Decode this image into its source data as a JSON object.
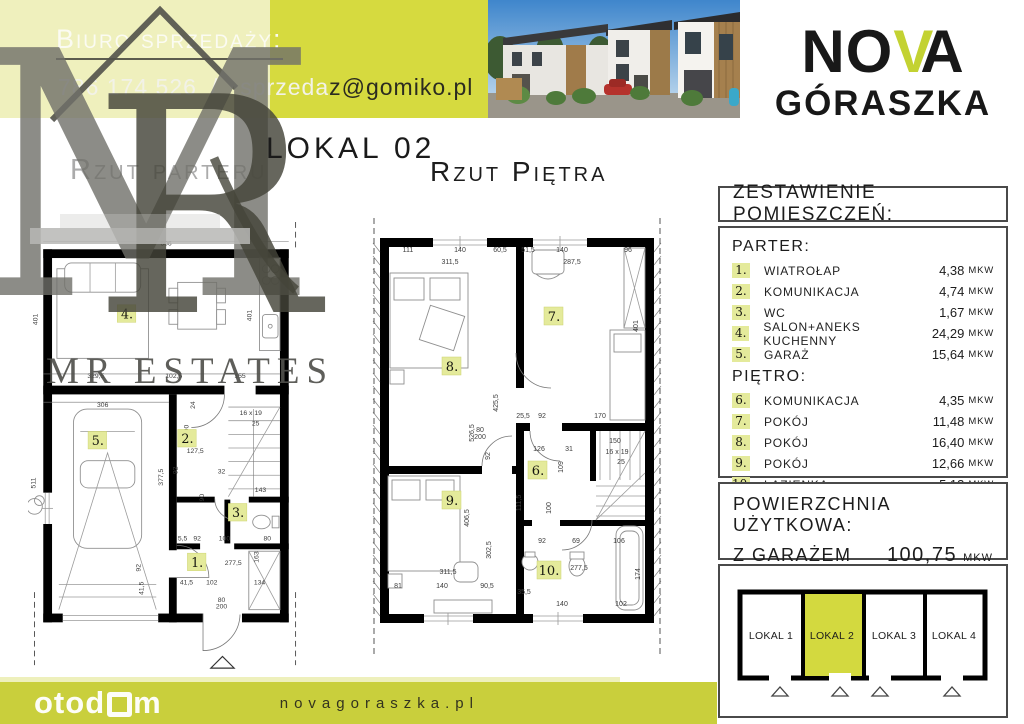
{
  "contact": {
    "title": "Biuro sprzedaży:",
    "phone": "786 174 526",
    "slash": "/",
    "email_light": "sprzeda",
    "email_dark": "z@gomiko.pl"
  },
  "brand": {
    "name_no": "NO",
    "name_v": "V",
    "name_a": "A",
    "line2": "GÓRASZKA",
    "accent_color": "#c3d232"
  },
  "watermark": {
    "monogram_m": "M",
    "monogram_r": "R",
    "estates": "MR ESTATES"
  },
  "titles": {
    "lokal": "LOKAL 02",
    "parter": "Rzut parteru",
    "pietro": "Rzut Piętra"
  },
  "table": {
    "header": "ZESTAWIENIE POMIESZCZEŃ:",
    "sections": [
      {
        "label": "PARTER:",
        "rows": [
          {
            "num": "1.",
            "name": "WIATROŁAP",
            "area": "4,38",
            "unit": "MKW"
          },
          {
            "num": "2.",
            "name": "KOMUNIKACJA",
            "area": "4,74",
            "unit": "MKW"
          },
          {
            "num": "3.",
            "name": "WC",
            "area": "1,67",
            "unit": "MKW"
          },
          {
            "num": "4.",
            "name": "SALON+ANEKS KUCHENNY",
            "area": "24,29",
            "unit": "MKW"
          },
          {
            "num": "5.",
            "name": "GARAŻ",
            "area": "15,64",
            "unit": "MKW"
          }
        ]
      },
      {
        "label": "PIĘTRO:",
        "rows": [
          {
            "num": "6.",
            "name": "KOMUNIKACJA",
            "area": "4,35",
            "unit": "MKW"
          },
          {
            "num": "7.",
            "name": "POKÓJ",
            "area": "11,48",
            "unit": "MKW"
          },
          {
            "num": "8.",
            "name": "POKÓJ",
            "area": "16,40",
            "unit": "MKW"
          },
          {
            "num": "9.",
            "name": "POKÓJ",
            "area": "12,66",
            "unit": "MKW"
          },
          {
            "num": "10.",
            "name": "ŁAZIENKA",
            "area": "5,13",
            "unit": "MKW"
          }
        ]
      }
    ]
  },
  "area_summary": {
    "line1": "POWIERZCHNIA UŻYTKOWA:",
    "line2": "Z GARAŻEM",
    "value": "100,75",
    "unit": "MKW"
  },
  "units": {
    "active_color": "#d3d93f",
    "items": [
      {
        "label": "LOKAL 1",
        "active": false
      },
      {
        "label": "LOKAL 2",
        "active": true
      },
      {
        "label": "LOKAL 3",
        "active": false
      },
      {
        "label": "LOKAL 4",
        "active": false
      }
    ]
  },
  "footer": {
    "logo_pre": "otod",
    "logo_post": "m",
    "website": "novagoraszka.pl"
  },
  "plans": {
    "parter": {
      "rooms": [
        {
          "num": "4."
        },
        {
          "num": "5."
        },
        {
          "num": "2."
        },
        {
          "num": "3."
        },
        {
          "num": "1."
        }
      ],
      "stairs_label": "16 x 19",
      "dims": [
        {
          "t": "606",
          "x": 140,
          "y": 24
        },
        {
          "t": "401",
          "x": 8,
          "y": 100,
          "r": -90
        },
        {
          "t": "401",
          "x": 228,
          "y": 96,
          "r": -90
        },
        {
          "t": "329,5",
          "x": 68,
          "y": 160
        },
        {
          "t": "102,5",
          "x": 148,
          "y": 160
        },
        {
          "t": "155",
          "x": 216,
          "y": 160
        },
        {
          "t": "306",
          "x": 75,
          "y": 190
        },
        {
          "t": "377,5",
          "x": 137,
          "y": 262,
          "r": -90
        },
        {
          "t": "511",
          "x": 6,
          "y": 268,
          "r": -90
        },
        {
          "t": "24",
          "x": 170,
          "y": 188,
          "r": -90
        },
        {
          "t": "100",
          "x": 163,
          "y": 214,
          "r": -90
        },
        {
          "t": "16 x 19",
          "x": 227,
          "y": 198
        },
        {
          "t": "25",
          "x": 232,
          "y": 209
        },
        {
          "t": "127,5",
          "x": 170,
          "y": 237
        },
        {
          "t": "92",
          "x": 152,
          "y": 255,
          "r": -90
        },
        {
          "t": "32",
          "x": 197,
          "y": 258
        },
        {
          "t": "90",
          "x": 179,
          "y": 283,
          "r": -90
        },
        {
          "t": "143",
          "x": 237,
          "y": 277
        },
        {
          "t": "5,5",
          "x": 157,
          "y": 327
        },
        {
          "t": "92",
          "x": 172,
          "y": 327
        },
        {
          "t": "100",
          "x": 200,
          "y": 327
        },
        {
          "t": "80",
          "x": 244,
          "y": 327
        },
        {
          "t": "277,5",
          "x": 209,
          "y": 352
        },
        {
          "t": "163",
          "x": 235,
          "y": 344,
          "r": -90
        },
        {
          "t": "41,5",
          "x": 161,
          "y": 372
        },
        {
          "t": "102",
          "x": 187,
          "y": 372
        },
        {
          "t": "134",
          "x": 236,
          "y": 372
        },
        {
          "t": "92",
          "x": 114,
          "y": 355,
          "r": -90
        },
        {
          "t": "41,5",
          "x": 117,
          "y": 376,
          "r": -90
        },
        {
          "t": "80",
          "x": 197,
          "y": 390
        },
        {
          "t": "200",
          "x": 197,
          "y": 397
        }
      ]
    },
    "pietro": {
      "rooms": [
        {
          "num": "7."
        },
        {
          "num": "8."
        },
        {
          "num": "9."
        },
        {
          "num": "6."
        },
        {
          "num": "10."
        }
      ],
      "dims": [
        {
          "t": "111",
          "x": 36,
          "y": 34
        },
        {
          "t": "140",
          "x": 88,
          "y": 34
        },
        {
          "t": "60,5",
          "x": 128,
          "y": 34
        },
        {
          "t": "311,5",
          "x": 78,
          "y": 46
        },
        {
          "t": "51,5",
          "x": 156,
          "y": 34
        },
        {
          "t": "140",
          "x": 190,
          "y": 34
        },
        {
          "t": "96",
          "x": 256,
          "y": 34
        },
        {
          "t": "287,5",
          "x": 200,
          "y": 46
        },
        {
          "t": "425,5",
          "x": 126,
          "y": 185,
          "r": -90
        },
        {
          "t": "526,5",
          "x": 102,
          "y": 215,
          "r": -90
        },
        {
          "t": "401",
          "x": 266,
          "y": 108,
          "r": -90
        },
        {
          "t": "25,5",
          "x": 151,
          "y": 200
        },
        {
          "t": "92",
          "x": 170,
          "y": 200
        },
        {
          "t": "170",
          "x": 228,
          "y": 200
        },
        {
          "t": "126",
          "x": 167,
          "y": 233
        },
        {
          "t": "31",
          "x": 197,
          "y": 233
        },
        {
          "t": "109",
          "x": 191,
          "y": 249,
          "r": -90
        },
        {
          "t": "92",
          "x": 118,
          "y": 238,
          "r": -90
        },
        {
          "t": "111,5",
          "x": 149,
          "y": 285,
          "r": -90
        },
        {
          "t": "100",
          "x": 179,
          "y": 290,
          "r": -90
        },
        {
          "t": "150",
          "x": 243,
          "y": 225
        },
        {
          "t": "16 x 19",
          "x": 245,
          "y": 236
        },
        {
          "t": "25",
          "x": 249,
          "y": 246
        },
        {
          "t": "406,5",
          "x": 97,
          "y": 300,
          "r": -90
        },
        {
          "t": "302,5",
          "x": 119,
          "y": 332,
          "r": -90
        },
        {
          "t": "311,5",
          "x": 76,
          "y": 356
        },
        {
          "t": "140",
          "x": 70,
          "y": 370
        },
        {
          "t": "90,5",
          "x": 115,
          "y": 370
        },
        {
          "t": "81",
          "x": 26,
          "y": 370
        },
        {
          "t": "92",
          "x": 170,
          "y": 325
        },
        {
          "t": "69",
          "x": 204,
          "y": 325
        },
        {
          "t": "106",
          "x": 247,
          "y": 325
        },
        {
          "t": "277,5",
          "x": 207,
          "y": 352
        },
        {
          "t": "174",
          "x": 268,
          "y": 356,
          "r": -90
        },
        {
          "t": "35,5",
          "x": 152,
          "y": 376
        },
        {
          "t": "140",
          "x": 190,
          "y": 388
        },
        {
          "t": "102",
          "x": 249,
          "y": 388
        },
        {
          "t": "80",
          "x": 108,
          "y": 214
        },
        {
          "t": "200",
          "x": 108,
          "y": 221
        }
      ]
    }
  }
}
